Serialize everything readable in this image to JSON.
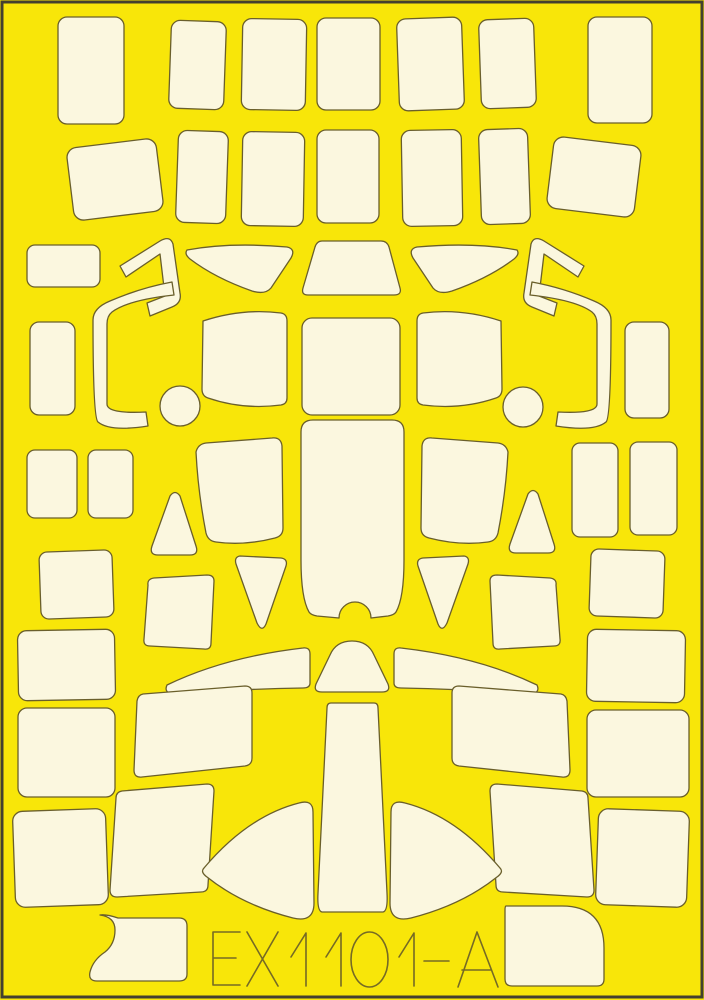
{
  "sheet": {
    "code": "EX1101-A",
    "colors": {
      "background": "#F8E609",
      "mask_fill": "#FBF7DF",
      "outline": "#6A5F2B",
      "border": "#43402F",
      "code_color": "#756A25"
    },
    "masks": [
      {
        "name": "top-rect-1",
        "type": "rect",
        "x": 58,
        "y": 17,
        "w": 66,
        "h": 107,
        "rx": 9,
        "rot": 0
      },
      {
        "name": "top-rect-2",
        "type": "rect",
        "x": 170,
        "y": 21,
        "w": 55,
        "h": 88,
        "rx": 9,
        "rot": 2
      },
      {
        "name": "top-rect-3",
        "type": "rect",
        "x": 242,
        "y": 19,
        "w": 64,
        "h": 91,
        "rx": 9,
        "rot": 1
      },
      {
        "name": "top-rect-4",
        "type": "rect",
        "x": 317,
        "y": 18,
        "w": 63,
        "h": 92,
        "rx": 9,
        "rot": 0
      },
      {
        "name": "top-rect-5",
        "type": "rect",
        "x": 398,
        "y": 18,
        "w": 65,
        "h": 92,
        "rx": 9,
        "rot": -2
      },
      {
        "name": "top-rect-6",
        "type": "rect",
        "x": 480,
        "y": 19,
        "w": 55,
        "h": 89,
        "rx": 9,
        "rot": -2
      },
      {
        "name": "top-rect-7",
        "type": "rect",
        "x": 588,
        "y": 17,
        "w": 64,
        "h": 106,
        "rx": 9,
        "rot": 0
      },
      {
        "name": "row2-tilted-left",
        "type": "rect",
        "x": 70,
        "y": 143,
        "w": 90,
        "h": 73,
        "rx": 10,
        "rot": -7
      },
      {
        "name": "row2-rect-1",
        "type": "rect",
        "x": 177,
        "y": 131,
        "w": 50,
        "h": 92,
        "rx": 9,
        "rot": 2
      },
      {
        "name": "row2-rect-2",
        "type": "rect",
        "x": 242,
        "y": 132,
        "w": 62,
        "h": 94,
        "rx": 9,
        "rot": 1
      },
      {
        "name": "row2-rect-3",
        "type": "rect",
        "x": 317,
        "y": 130,
        "w": 62,
        "h": 93,
        "rx": 9,
        "rot": 0
      },
      {
        "name": "row2-rect-4",
        "type": "rect",
        "x": 402,
        "y": 130,
        "w": 60,
        "h": 96,
        "rx": 9,
        "rot": -1
      },
      {
        "name": "row2-rect-5",
        "type": "rect",
        "x": 480,
        "y": 129,
        "w": 49,
        "h": 95,
        "rx": 9,
        "rot": -2
      },
      {
        "name": "row2-tilted-right",
        "type": "rect",
        "x": 550,
        "y": 141,
        "w": 88,
        "h": 72,
        "rx": 10,
        "rot": 7
      },
      {
        "name": "edge-wide-left",
        "type": "rect",
        "x": 27,
        "y": 245,
        "w": 73,
        "h": 42,
        "rx": 8,
        "rot": 0
      },
      {
        "name": "edge-tall-left",
        "type": "rect",
        "x": 30,
        "y": 322,
        "w": 45,
        "h": 93,
        "rx": 9,
        "rot": 0
      },
      {
        "name": "edge-tall-right",
        "type": "rect",
        "x": 625,
        "y": 322,
        "w": 44,
        "h": 96,
        "rx": 9,
        "rot": 0
      },
      {
        "name": "pair-left-1",
        "type": "rect",
        "x": 27,
        "y": 450,
        "w": 50,
        "h": 68,
        "rx": 8,
        "rot": 0
      },
      {
        "name": "pair-left-2",
        "type": "rect",
        "x": 88,
        "y": 450,
        "w": 45,
        "h": 68,
        "rx": 8,
        "rot": 0
      },
      {
        "name": "pair-right-1",
        "type": "rect",
        "x": 572,
        "y": 443,
        "w": 46,
        "h": 94,
        "rx": 8,
        "rot": 0
      },
      {
        "name": "pair-right-2",
        "type": "rect",
        "x": 630,
        "y": 442,
        "w": 47,
        "h": 93,
        "rx": 8,
        "rot": 0
      },
      {
        "name": "square-left",
        "type": "rect",
        "x": 40,
        "y": 551,
        "w": 73,
        "h": 67,
        "rx": 8,
        "rot": -2
      },
      {
        "name": "square-right",
        "type": "rect",
        "x": 590,
        "y": 550,
        "w": 74,
        "h": 67,
        "rx": 8,
        "rot": 2
      },
      {
        "name": "hook-upper-left",
        "type": "path",
        "d": "M120,266 L160,241 Q170,235 173,244 L180,293 Q182,303 172,307 L150,316 L147,303 L165,296 L160,254 L126,277 Z"
      },
      {
        "name": "hook-lower-left",
        "type": "path",
        "d": "M174,295 Q128,300 112,312 Q107,316 107,324 L107,404 Q107,414 146,412 L148,426 Q110,432 98,422 Q93,418 93,320 Q93,308 110,301 Q140,288 172,282 Z"
      },
      {
        "name": "hook-upper-right",
        "type": "path",
        "d": "M584,266 L544,241 Q534,235 531,244 L524,293 Q522,303 532,307 L554,316 L557,303 L539,296 L544,254 L578,277 Z"
      },
      {
        "name": "hook-lower-right",
        "type": "path",
        "d": "M530,295 Q576,300 592,312 Q597,316 597,324 L597,404 Q597,414 558,412 L556,426 Q594,432 606,422 Q611,418 611,320 Q611,308 594,301 Q564,288 532,282 Z"
      },
      {
        "name": "wedge-left",
        "type": "path",
        "d": "M187,250 Q230,242 287,247 Q296,249 291,258 L271,288 Q265,295 252,291 Q215,278 190,259 Q184,254 187,250 Z"
      },
      {
        "name": "wedge-right",
        "type": "path",
        "d": "M517,250 Q474,242 417,247 Q408,249 413,258 L433,288 Q439,295 452,291 Q489,278 514,259 Q520,254 517,250 Z"
      },
      {
        "name": "windscreen-front",
        "type": "path",
        "d": "M322,241 L381,241 Q387,241 389,247 L400,288 Q402,295 394,295 L308,295 Q301,295 303,288 L315,247 Q317,241 322,241 Z"
      },
      {
        "name": "windscreen-left",
        "type": "path",
        "d": "M203,321 Q242,308 281,313 Q287,314 287,321 L287,398 Q287,404 281,405 Q243,410 208,398 Q202,396 202,389 Z"
      },
      {
        "name": "windscreen-center",
        "type": "rect",
        "x": 302,
        "y": 318,
        "w": 98,
        "h": 97,
        "rx": 10,
        "rot": 0
      },
      {
        "name": "windscreen-right",
        "type": "path",
        "d": "M501,321 Q462,308 423,313 Q417,314 417,321 L417,398 Q417,404 423,405 Q461,410 496,398 Q502,396 502,389 Z"
      },
      {
        "name": "circle-left",
        "type": "circle",
        "cx": 180,
        "cy": 406,
        "r": 20
      },
      {
        "name": "circle-right",
        "type": "circle",
        "cx": 523,
        "cy": 407,
        "r": 20
      },
      {
        "name": "canopy-center",
        "type": "path",
        "d": "M313,420 L392,420 Q404,420 404,432 L404,560 Q404,598 396,612 Q394,615 388,616 L371,618 A16,16 0 0 0 339,618 L317,616 Q311,615 309,612 Q301,598 301,560 L301,432 Q301,420 313,420 Z"
      },
      {
        "name": "canopy-side-left",
        "type": "path",
        "d": "M196,452 Q198,444 206,443 L272,438 Q281,437 282,446 L283,528 Q283,536 275,538 Q244,546 216,542 Q208,541 206,533 Q198,492 196,452 Z"
      },
      {
        "name": "canopy-side-right",
        "type": "path",
        "d": "M508,452 Q506,444 498,443 L432,438 Q423,437 422,446 L421,528 Q421,536 429,538 Q460,546 488,542 Q496,541 498,533 Q506,492 508,452 Z"
      },
      {
        "name": "tri-up-left",
        "type": "path",
        "d": "M170,496 Q175,489 180,496 L196,546 Q199,555 190,555 L158,555 Q149,555 152,546 Z"
      },
      {
        "name": "tri-up-right",
        "type": "path",
        "d": "M528,494 Q533,487 538,494 L554,544 Q557,553 548,553 L516,553 Q507,553 510,544 Z"
      },
      {
        "name": "tri-down-left",
        "type": "path",
        "d": "M240,556 L281,558 Q288,559 286,566 L266,624 Q262,633 257,623 L236,564 Q234,557 240,556 Z"
      },
      {
        "name": "tri-down-right",
        "type": "path",
        "d": "M464,556 L423,558 Q416,559 418,566 L438,624 Q442,633 447,623 L468,564 Q470,557 464,556 Z"
      },
      {
        "name": "mid-quad-left",
        "type": "path",
        "d": "M148,585 Q147,579 154,578 L207,575 Q214,575 214,581 L211,643 Q211,650 204,649 L150,646 Q143,646 144,639 Z"
      },
      {
        "name": "mid-quad-right",
        "type": "path",
        "d": "M556,585 Q557,579 550,578 L497,575 Q490,575 490,581 L493,643 Q493,650 500,649 L554,646 Q561,646 560,639 Z"
      },
      {
        "name": "trapezoid-bump",
        "type": "path",
        "d": "M330,655 Q336,641 352,641 Q368,641 374,655 L388,684 Q391,692 382,692 L322,692 Q313,692 316,684 Z"
      },
      {
        "name": "thin-wedge-left",
        "type": "path",
        "d": "M167,685 Q225,657 303,648 Q310,647 310,654 L310,683 Q310,688 303,688 Q240,689 176,694 Q163,694 167,685 Z"
      },
      {
        "name": "thin-wedge-right",
        "type": "path",
        "d": "M537,685 Q479,657 401,648 Q394,647 394,654 L394,683 Q394,688 401,688 Q464,689 528,694 Q541,694 537,685 Z"
      },
      {
        "name": "tail-column",
        "type": "path",
        "d": "M331,703 L374,703 Q378,703 378,708 L387,893 Q388,911 383,912 L322,912 Q317,911 318,893 L327,708 Q327,703 331,703 Z"
      },
      {
        "name": "quad-a-left",
        "type": "path",
        "d": "M143,694 L245,686 Q252,686 252,693 L252,758 Q252,765 245,766 L142,777 Q134,778 134,770 L137,701 Q138,695 143,694 Z"
      },
      {
        "name": "quad-a-right",
        "type": "path",
        "d": "M561,694 L459,686 Q452,686 452,693 L452,758 Q452,765 459,766 L562,777 Q570,778 570,770 L567,701 Q566,695 561,694 Z"
      },
      {
        "name": "quad-b-left",
        "type": "path",
        "d": "M122,791 L207,784 Q214,784 214,791 L208,885 Q208,892 201,892 L117,897 Q110,897 110,890 L116,798 Q116,792 122,791 Z"
      },
      {
        "name": "quad-b-right",
        "type": "path",
        "d": "M582,791 L497,784 Q490,784 490,791 L496,885 Q496,892 503,892 L587,897 Q594,897 594,890 L588,798 Q588,792 582,791 Z"
      },
      {
        "name": "left-col-rect-1",
        "type": "rect",
        "x": 18,
        "y": 630,
        "w": 97,
        "h": 70,
        "rx": 9,
        "rot": -1
      },
      {
        "name": "left-col-rect-2",
        "type": "rect",
        "x": 18,
        "y": 708,
        "w": 97,
        "h": 89,
        "rx": 9,
        "rot": 0
      },
      {
        "name": "right-col-rect-1",
        "type": "rect",
        "x": 587,
        "y": 630,
        "w": 98,
        "h": 72,
        "rx": 9,
        "rot": 1
      },
      {
        "name": "right-col-rect-2",
        "type": "rect",
        "x": 587,
        "y": 710,
        "w": 102,
        "h": 87,
        "rx": 9,
        "rot": 0
      },
      {
        "name": "bottom-square-left",
        "type": "rect",
        "x": 14,
        "y": 810,
        "w": 93,
        "h": 96,
        "rx": 10,
        "rot": -2
      },
      {
        "name": "bottom-square-right",
        "type": "rect",
        "x": 597,
        "y": 810,
        "w": 91,
        "h": 96,
        "rx": 10,
        "rot": 2
      },
      {
        "name": "lens-left",
        "type": "path",
        "d": "M204,868 Q248,816 299,803 Q313,799 313,812 L314,903 Q314,923 293,918 Q242,905 207,877 Q200,872 204,868 Z"
      },
      {
        "name": "lens-right",
        "type": "path",
        "d": "M500,868 Q456,816 405,803 Q391,799 391,812 L390,903 Q390,923 411,918 Q462,905 497,877 Q504,872 500,868 Z"
      },
      {
        "name": "boot-piece",
        "type": "path",
        "d": "M100,915 Q115,917 115,930 Q115,944 105,952 Q93,960 90,972 Q88,981 97,981 L179,981 Q187,981 187,974 L187,926 Q187,918 179,918 L118,918 Q106,914 100,915 Z"
      },
      {
        "name": "bottom-right-block",
        "type": "path",
        "d": "M506,906 L562,906 Q604,906 604,948 L604,979 Q604,986 597,986 L512,986 Q505,986 505,979 L505,910 Q505,906 506,906 Z"
      }
    ],
    "code_glyphs": [
      {
        "char": "E",
        "d": "M240,932 L213,932 L213,985 L240,985 M213,958 L236,958"
      },
      {
        "char": "X",
        "d": "M247,932 L278,986 M278,932 L247,986"
      },
      {
        "char": "1",
        "d": "M291,957 L306,933 L306,986"
      },
      {
        "char": "1",
        "d": "M326,957 L341,933 L341,986"
      },
      {
        "char": "0",
        "d": "M351,959.5 A18.5,27.5 0 1 0 388,959.5 A18.5,27.5 0 1 0 351,959.5 Z"
      },
      {
        "char": "1",
        "d": "M399,957 L414,933 L414,986"
      },
      {
        "char": "-",
        "d": "M424,961 L449,961"
      },
      {
        "char": "A",
        "d": "M458,987 L477,932 L498,987 M462,970 L491,970"
      }
    ]
  }
}
